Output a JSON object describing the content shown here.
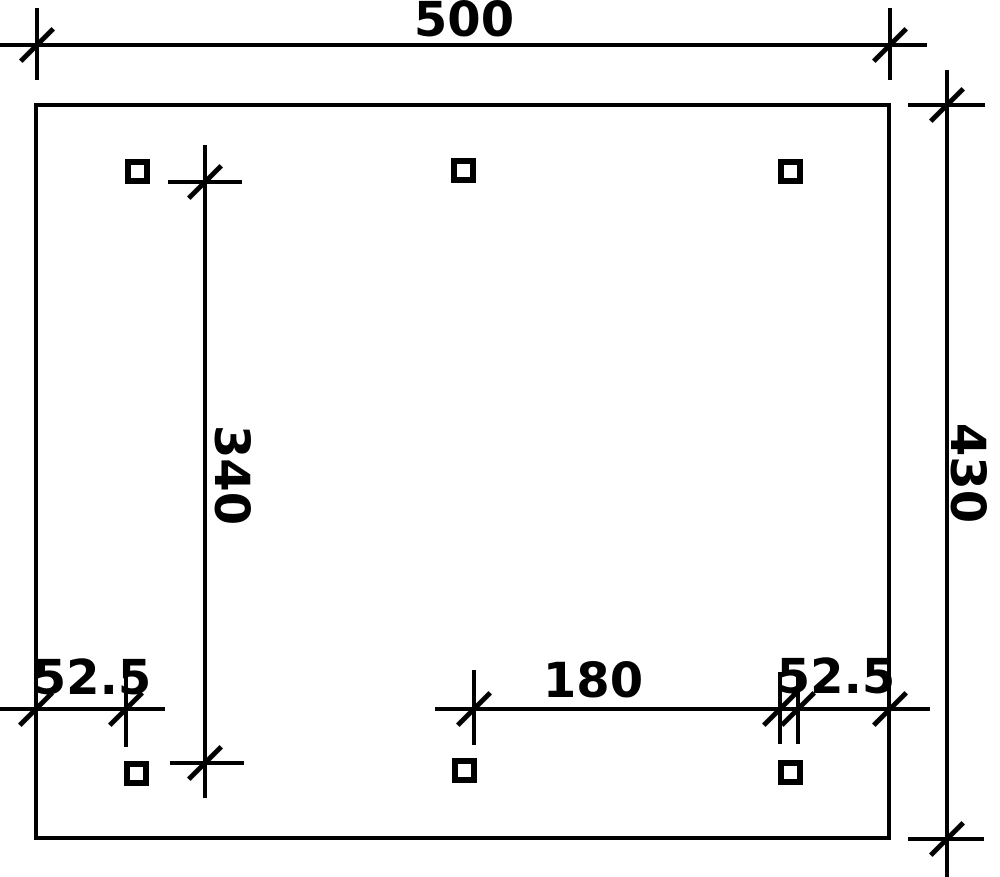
{
  "drawing": {
    "type": "dimensioned floor plan",
    "colors": {
      "line": "#000000",
      "background": "#ffffff"
    },
    "dimensions": {
      "top_width": {
        "label": "500"
      },
      "right_height": {
        "label": "430"
      },
      "left_inner_height": {
        "label": "340"
      },
      "bottom_center_span": {
        "label": "180"
      },
      "bottom_left_offset": {
        "label": "52.5"
      },
      "bottom_right_offset": {
        "label": "52.5"
      }
    },
    "posts": {
      "count": 6,
      "rows": 2,
      "per_row": 3
    }
  }
}
